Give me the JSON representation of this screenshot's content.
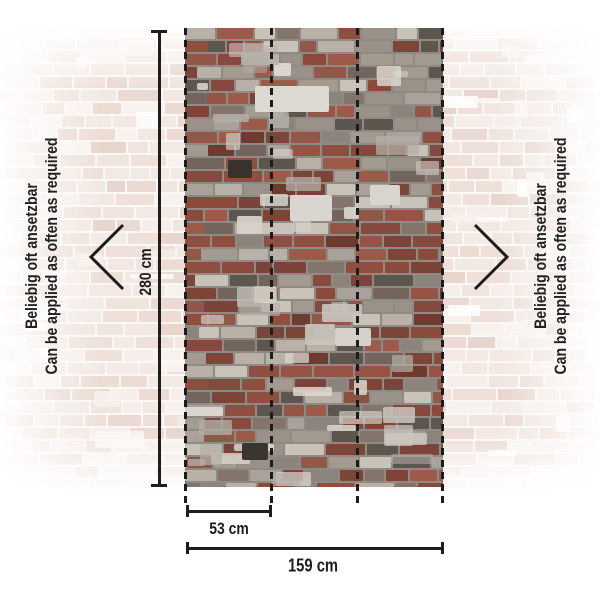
{
  "side_note": {
    "de": "Beliebig oft ansetzbar",
    "en": "Can be applied as often as required"
  },
  "annotation": {
    "height_label": "280 cm",
    "panel_width_label": "53 cm",
    "total_width_label": "159 cm"
  },
  "icons": {
    "chevron_left": "chevron-left",
    "chevron_right": "chevron-right"
  },
  "colors": {
    "annotation": "#1d1d1d",
    "brick_red": "#7d4438",
    "mortar_grey": "#8f8a84",
    "faded_wall": "#f2e7e2",
    "background": "#ffffff"
  }
}
